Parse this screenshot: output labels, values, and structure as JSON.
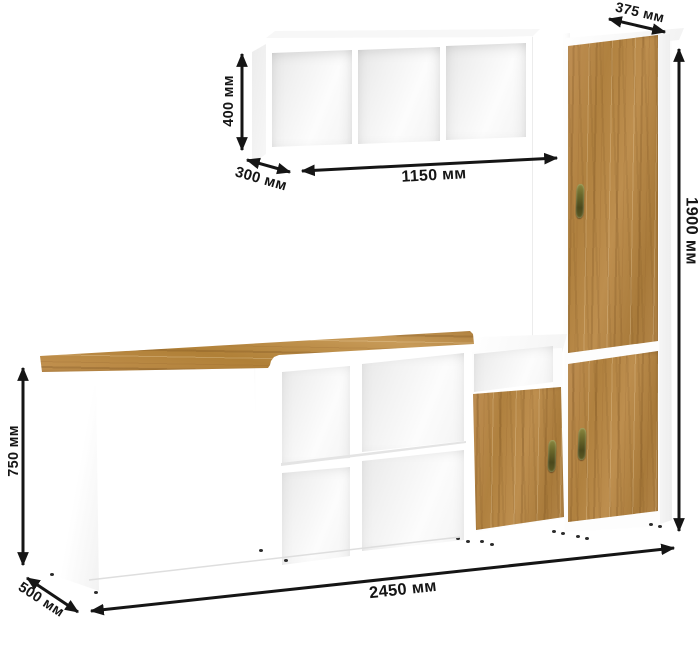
{
  "diagram": {
    "type": "furniture-dimensions",
    "units": "мм",
    "labels": {
      "wall_shelf_height": "400 мм",
      "wall_shelf_depth": "300 мм",
      "wall_shelf_width": "1150 мм",
      "tall_cabinet_depth": "375 мм",
      "tall_cabinet_height": "1900 мм",
      "desk_height": "750 мм",
      "desk_depth": "500 мм",
      "total_width": "2450 мм"
    },
    "colors": {
      "annotation": "#151515",
      "wood_base": "#b5854a",
      "wood_dark": "#8f6434",
      "wood_light": "#cfa263",
      "handle_bronze": "#5c5a24",
      "furniture_white": "#ffffff",
      "background": "#ffffff"
    }
  }
}
